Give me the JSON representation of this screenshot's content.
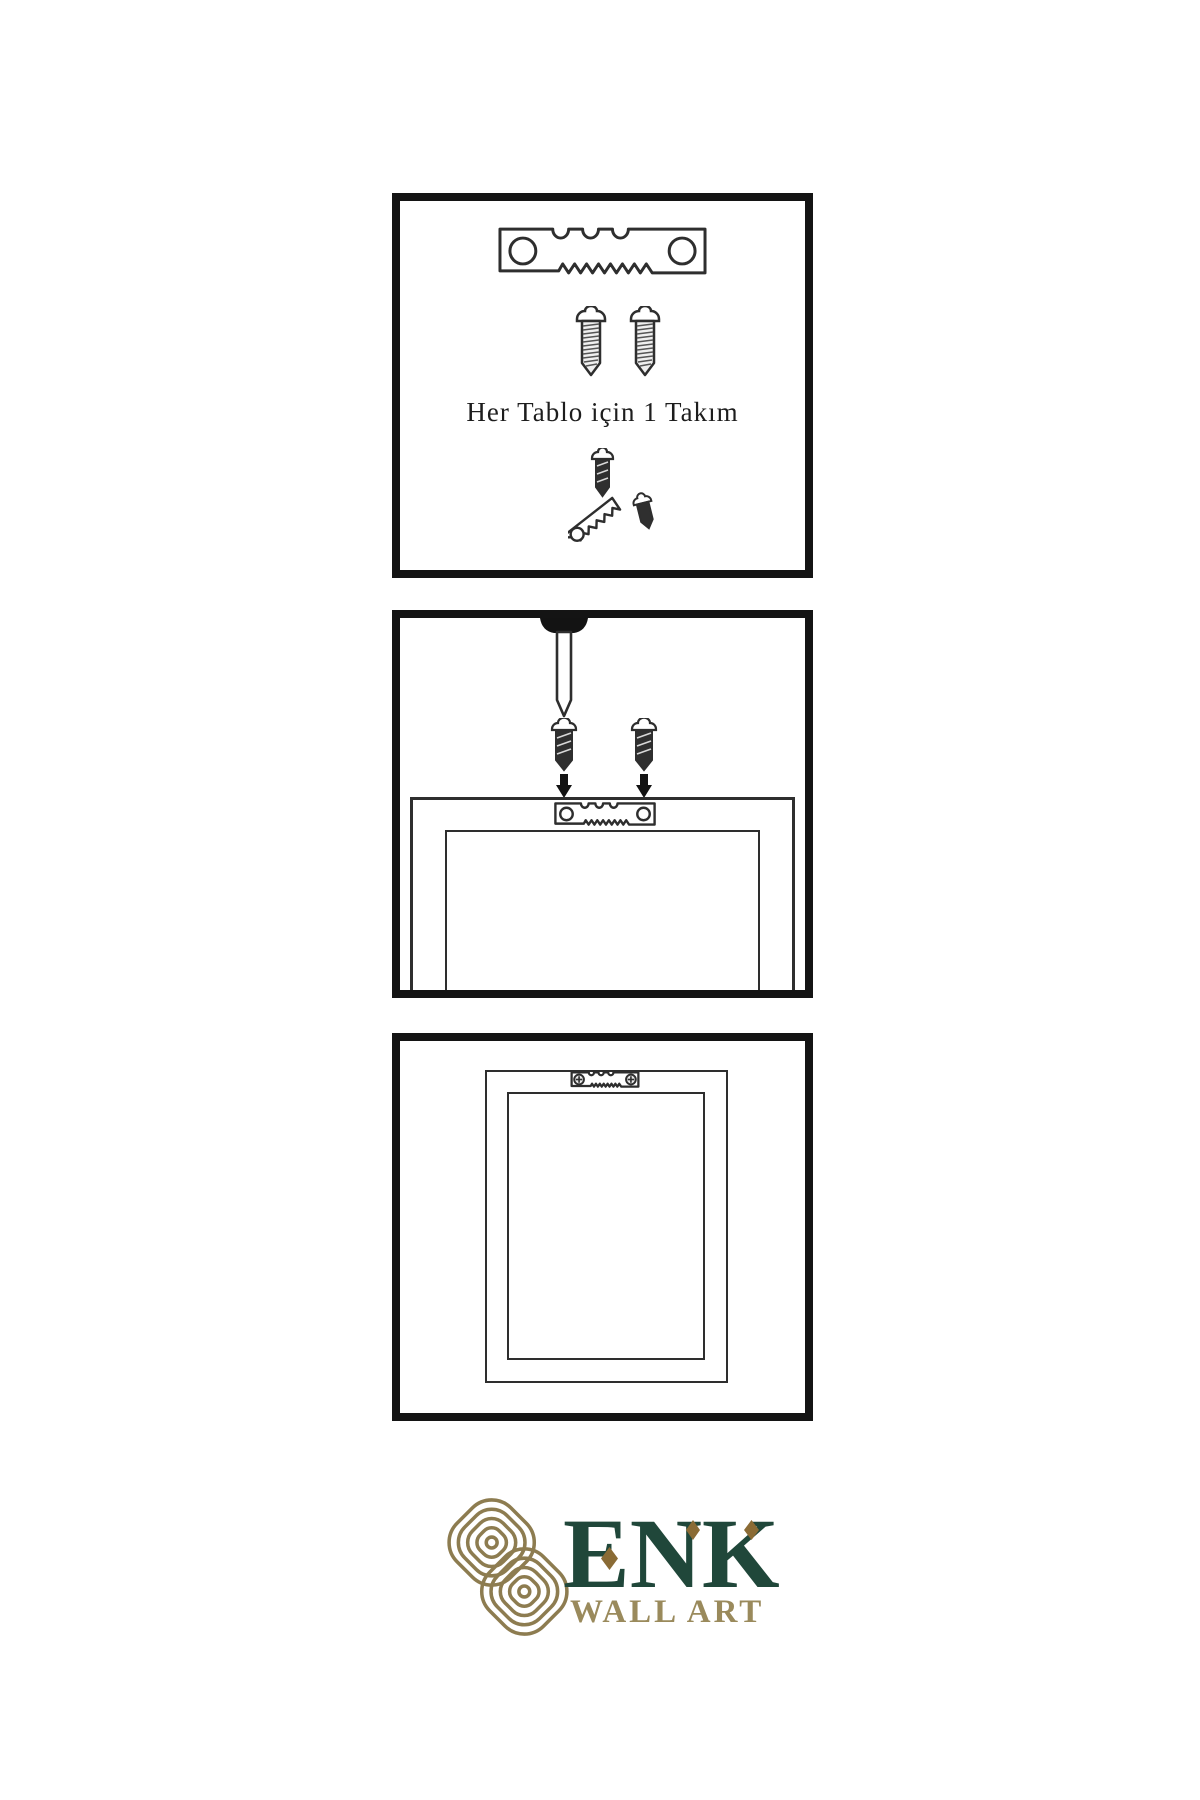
{
  "page": {
    "background": "#ffffff",
    "type": "wall-art-hanging-instruction-sheet"
  },
  "steps": [
    {
      "index": 1,
      "caption": "Her Tablo için 1 Takım",
      "icons": [
        "sawtooth-hanger",
        "screw",
        "screw",
        "screw-driven-into-hanger",
        "screw-small"
      ]
    },
    {
      "index": 2,
      "caption": "",
      "icons": [
        "wall-nail",
        "screw",
        "screw",
        "down-arrow",
        "down-arrow",
        "frame-back",
        "sawtooth-hanger-on-frame"
      ]
    },
    {
      "index": 3,
      "caption": "",
      "icons": [
        "frame-back",
        "sawtooth-hanger-mounted-with-screws"
      ]
    }
  ],
  "brand": {
    "name": "ENK",
    "subtitle": "WALL ART",
    "logo_icon": "interlocking-knot-monogram",
    "colors": {
      "wordmark_green": "#20473a",
      "subtitle_gold": "#9a8a5c",
      "knot_gold": "#8d7c50",
      "diamond_gold": "#8a6b35",
      "panel_border": "#141414",
      "line_art": "#2e2e2e"
    }
  }
}
